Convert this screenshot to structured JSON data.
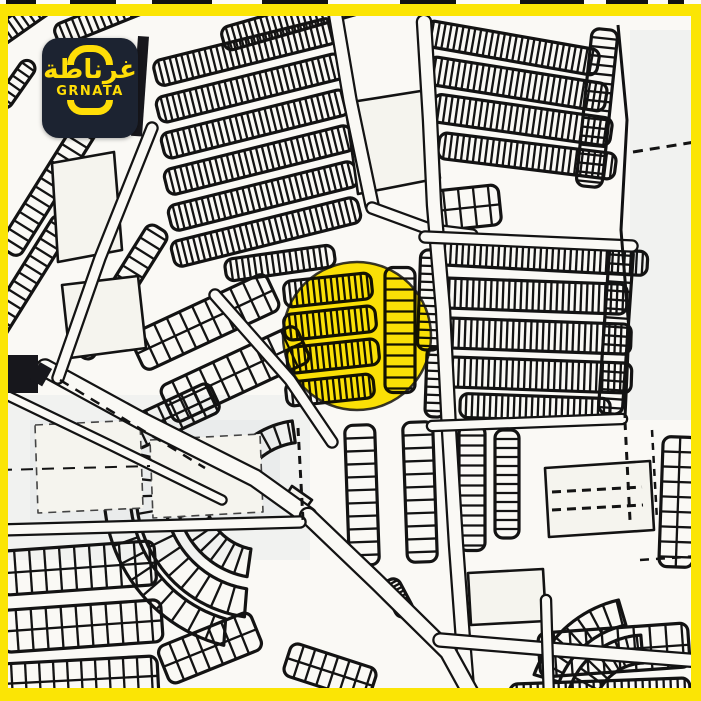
{
  "meta": {
    "width": 701,
    "height": 701
  },
  "colors": {
    "frame_yellow": "#FBE505",
    "highlight_yellow": "#FFE606",
    "logo_bg": "#1C2331",
    "logo_yellow": "#FFDE07",
    "map_bg": "#FAF9F5",
    "plot_fill": "#F5F4EE",
    "line": "#131313",
    "tint": "#C7D0DC",
    "dark_block": "#17171C"
  },
  "logo": {
    "arabic": "غرناطة",
    "latin": "GRNATA"
  },
  "highlight": {
    "cx": 357,
    "cy": 336,
    "r": 74,
    "ring_width": 2.5
  },
  "frame": {
    "top": 12,
    "right": 10,
    "bottom": 13,
    "left": 8
  },
  "map": {
    "combs": [
      [
        28,
        16,
        80,
        20,
        -35,
        7,
        0
      ],
      [
        112,
        14,
        120,
        22,
        -22,
        7,
        0
      ],
      [
        16,
        84,
        54,
        16,
        -55,
        8,
        0
      ],
      [
        300,
        18,
        160,
        24,
        -16,
        6,
        0
      ],
      [
        245,
        52,
        185,
        26,
        -14,
        6,
        0
      ],
      [
        250,
        88,
        190,
        26,
        -14,
        6,
        0
      ],
      [
        255,
        124,
        190,
        26,
        -14,
        6,
        0
      ],
      [
        259,
        160,
        192,
        26,
        -14,
        6,
        0
      ],
      [
        263,
        196,
        192,
        26,
        -14,
        6,
        0
      ],
      [
        266,
        232,
        192,
        26,
        -14,
        6,
        0
      ],
      [
        280,
        263,
        110,
        22,
        -8,
        6,
        0
      ],
      [
        52,
        182,
        165,
        24,
        -58,
        10,
        0
      ],
      [
        28,
        278,
        140,
        22,
        -58,
        10,
        0
      ],
      [
        120,
        292,
        150,
        24,
        -58,
        11,
        0
      ],
      [
        205,
        322,
        150,
        40,
        -25,
        14,
        1
      ],
      [
        235,
        374,
        150,
        40,
        -25,
        15,
        1
      ],
      [
        172,
        416,
        95,
        32,
        -25,
        13,
        1
      ],
      [
        512,
        48,
        175,
        26,
        10,
        6,
        0
      ],
      [
        517,
        84,
        180,
        28,
        9,
        6,
        0
      ],
      [
        522,
        120,
        180,
        28,
        8,
        6,
        0
      ],
      [
        527,
        156,
        178,
        26,
        7,
        6,
        0
      ],
      [
        597,
        108,
        158,
        26,
        96,
        9,
        0
      ],
      [
        465,
        208,
        70,
        40,
        -6,
        15,
        1
      ],
      [
        540,
        258,
        215,
        24,
        3,
        6,
        0
      ],
      [
        532,
        296,
        190,
        30,
        2,
        6,
        0
      ],
      [
        536,
        336,
        190,
        30,
        2,
        6,
        0
      ],
      [
        539,
        375,
        185,
        30,
        2,
        6,
        0
      ],
      [
        430,
        300,
        100,
        22,
        92,
        8,
        0
      ],
      [
        436,
        382,
        70,
        20,
        92,
        8,
        0
      ],
      [
        616,
        330,
        168,
        24,
        94,
        9,
        0
      ],
      [
        328,
        290,
        88,
        26,
        -6,
        6,
        0
      ],
      [
        330,
        323,
        92,
        26,
        -6,
        6,
        0
      ],
      [
        333,
        356,
        92,
        26,
        -6,
        6,
        0
      ],
      [
        330,
        390,
        88,
        24,
        -6,
        6,
        0
      ],
      [
        400,
        330,
        125,
        30,
        90,
        11,
        0
      ],
      [
        362,
        495,
        140,
        30,
        88,
        13,
        0
      ],
      [
        420,
        492,
        140,
        30,
        88,
        13,
        0
      ],
      [
        472,
        488,
        125,
        26,
        90,
        10,
        0
      ],
      [
        507,
        484,
        108,
        24,
        90,
        9,
        0
      ],
      [
        614,
        650,
        150,
        44,
        -4,
        16,
        1
      ],
      [
        600,
        694,
        180,
        26,
        -2,
        7,
        0
      ],
      [
        678,
        502,
        130,
        34,
        92,
        15,
        1
      ],
      [
        535,
        408,
        150,
        24,
        2,
        6,
        0
      ],
      [
        78,
        568,
        155,
        44,
        -4,
        15,
        1
      ],
      [
        82,
        626,
        160,
        42,
        -4,
        15,
        1
      ],
      [
        78,
        680,
        160,
        40,
        -3,
        14,
        1
      ],
      [
        210,
        648,
        100,
        40,
        -22,
        14,
        1
      ],
      [
        330,
        672,
        90,
        34,
        18,
        12,
        1
      ],
      [
        398,
        598,
        40,
        18,
        62,
        4,
        0
      ]
    ],
    "arc_combs": [
      [
        262,
        492,
        58,
        86,
        100,
        212,
        9
      ],
      [
        262,
        492,
        98,
        126,
        98,
        198,
        8
      ],
      [
        262,
        492,
        132,
        158,
        104,
        178,
        7
      ],
      [
        305,
        512,
        70,
        92,
        205,
        262,
        9
      ],
      [
        645,
        715,
        52,
        80,
        192,
        268,
        8
      ],
      [
        645,
        715,
        92,
        118,
        200,
        258,
        7
      ]
    ],
    "plots": [
      {
        "pts": [
          [
            345,
            103
          ],
          [
            427,
            90
          ],
          [
            440,
            178
          ],
          [
            358,
            194
          ]
        ],
        "d": 0
      },
      {
        "pts": [
          [
            52,
            163
          ],
          [
            114,
            152
          ],
          [
            122,
            250
          ],
          [
            58,
            262
          ]
        ],
        "d": 0
      },
      {
        "pts": [
          [
            62,
            285
          ],
          [
            138,
            276
          ],
          [
            146,
            348
          ],
          [
            70,
            358
          ]
        ],
        "d": 0
      },
      {
        "pts": [
          [
            545,
            468
          ],
          [
            650,
            461
          ],
          [
            654,
            530
          ],
          [
            549,
            537
          ]
        ],
        "d": 0
      },
      {
        "pts": [
          [
            468,
            573
          ],
          [
            543,
            569
          ],
          [
            546,
            621
          ],
          [
            471,
            625
          ]
        ],
        "d": 0
      },
      {
        "pts": [
          [
            292,
            486
          ],
          [
            312,
            500
          ],
          [
            300,
            516
          ],
          [
            282,
            502
          ]
        ],
        "d": 0
      },
      {
        "pts": [
          [
            35,
            425
          ],
          [
            140,
            420
          ],
          [
            143,
            508
          ],
          [
            38,
            513
          ]
        ],
        "d": 1
      },
      {
        "pts": [
          [
            150,
            440
          ],
          [
            260,
            434
          ],
          [
            263,
            512
          ],
          [
            153,
            518
          ]
        ],
        "d": 1
      }
    ],
    "roads": [
      {
        "pts": [
          [
            333,
            0
          ],
          [
            350,
            100
          ],
          [
            372,
            205
          ]
        ],
        "w": 11
      },
      {
        "pts": [
          [
            372,
            208
          ],
          [
            432,
            230
          ],
          [
            472,
            235
          ]
        ],
        "w": 9
      },
      {
        "pts": [
          [
            424,
            22
          ],
          [
            430,
            120
          ],
          [
            434,
            205
          ],
          [
            443,
            310
          ],
          [
            449,
            430
          ],
          [
            456,
            545
          ],
          [
            463,
            640
          ],
          [
            468,
            701
          ]
        ],
        "w": 12
      },
      {
        "pts": [
          [
            425,
            237
          ],
          [
            632,
            246
          ]
        ],
        "w": 9
      },
      {
        "pts": [
          [
            45,
            368
          ],
          [
            140,
            420
          ],
          [
            255,
            478
          ],
          [
            308,
            516
          ]
        ],
        "w": 15
      },
      {
        "pts": [
          [
            308,
            516
          ],
          [
            378,
            583
          ],
          [
            448,
            652
          ],
          [
            475,
            701
          ]
        ],
        "w": 14
      },
      {
        "pts": [
          [
            440,
            640
          ],
          [
            560,
            650
          ],
          [
            701,
            661
          ]
        ],
        "w": 11
      },
      {
        "pts": [
          [
            0,
            392
          ],
          [
            112,
            446
          ],
          [
            222,
            500
          ]
        ],
        "w": 7
      },
      {
        "pts": [
          [
            0,
            530
          ],
          [
            300,
            522
          ]
        ],
        "w": 9
      },
      {
        "pts": [
          [
            432,
            426
          ],
          [
            622,
            419
          ]
        ],
        "w": 8
      },
      {
        "pts": [
          [
            546,
            600
          ],
          [
            549,
            701
          ]
        ],
        "w": 8
      },
      {
        "pts": [
          [
            152,
            128
          ],
          [
            100,
            258
          ],
          [
            58,
            378
          ]
        ],
        "w": 9
      },
      {
        "pts": [
          [
            215,
            295
          ],
          [
            290,
            380
          ],
          [
            332,
            442
          ]
        ],
        "w": 9
      }
    ],
    "lines": [
      {
        "pts": [
          [
            618,
            25
          ],
          [
            627,
            120
          ],
          [
            621,
            230
          ],
          [
            629,
            330
          ],
          [
            625,
            418
          ]
        ],
        "w": 3,
        "dash": ""
      },
      {
        "pts": [
          [
            625,
            422
          ],
          [
            630,
            520
          ]
        ],
        "w": 3,
        "dash": "8 7"
      },
      {
        "pts": [
          [
            633,
            152
          ],
          [
            701,
            141
          ]
        ],
        "w": 3,
        "dash": "10 7"
      },
      {
        "pts": [
          [
            298,
            428
          ],
          [
            303,
            520
          ]
        ],
        "w": 3,
        "dash": "8 6"
      },
      {
        "pts": [
          [
            552,
            492
          ],
          [
            642,
            487
          ]
        ],
        "w": 3,
        "dash": "9 6"
      },
      {
        "pts": [
          [
            552,
            510
          ],
          [
            643,
            505
          ]
        ],
        "w": 3,
        "dash": "9 6"
      },
      {
        "pts": [
          [
            60,
            380
          ],
          [
            205,
            468
          ]
        ],
        "w": 2.5,
        "dash": "10 8"
      },
      {
        "pts": [
          [
            652,
            430
          ],
          [
            657,
            520
          ]
        ],
        "w": 2.5,
        "dash": "7 6"
      },
      {
        "pts": [
          [
            0,
            470
          ],
          [
            150,
            466
          ]
        ],
        "w": 2,
        "dash": "12 9"
      },
      {
        "pts": [
          [
            640,
            560
          ],
          [
            700,
            556
          ]
        ],
        "w": 2.5,
        "dash": "9 7"
      }
    ],
    "darks": [
      [
        8,
        355,
        30,
        38,
        0
      ],
      [
        138,
        36,
        11,
        100,
        4
      ],
      [
        40,
        362,
        14,
        20,
        30
      ]
    ],
    "tints": [
      [
        0,
        395,
        310,
        165
      ],
      [
        630,
        30,
        70,
        390
      ],
      [
        30,
        420,
        250,
        100
      ]
    ],
    "top_fragments": [
      [
        6,
        30
      ],
      [
        70,
        46
      ],
      [
        152,
        60
      ],
      [
        262,
        66
      ],
      [
        400,
        56
      ],
      [
        520,
        64
      ],
      [
        606,
        42
      ],
      [
        668,
        16
      ]
    ]
  }
}
